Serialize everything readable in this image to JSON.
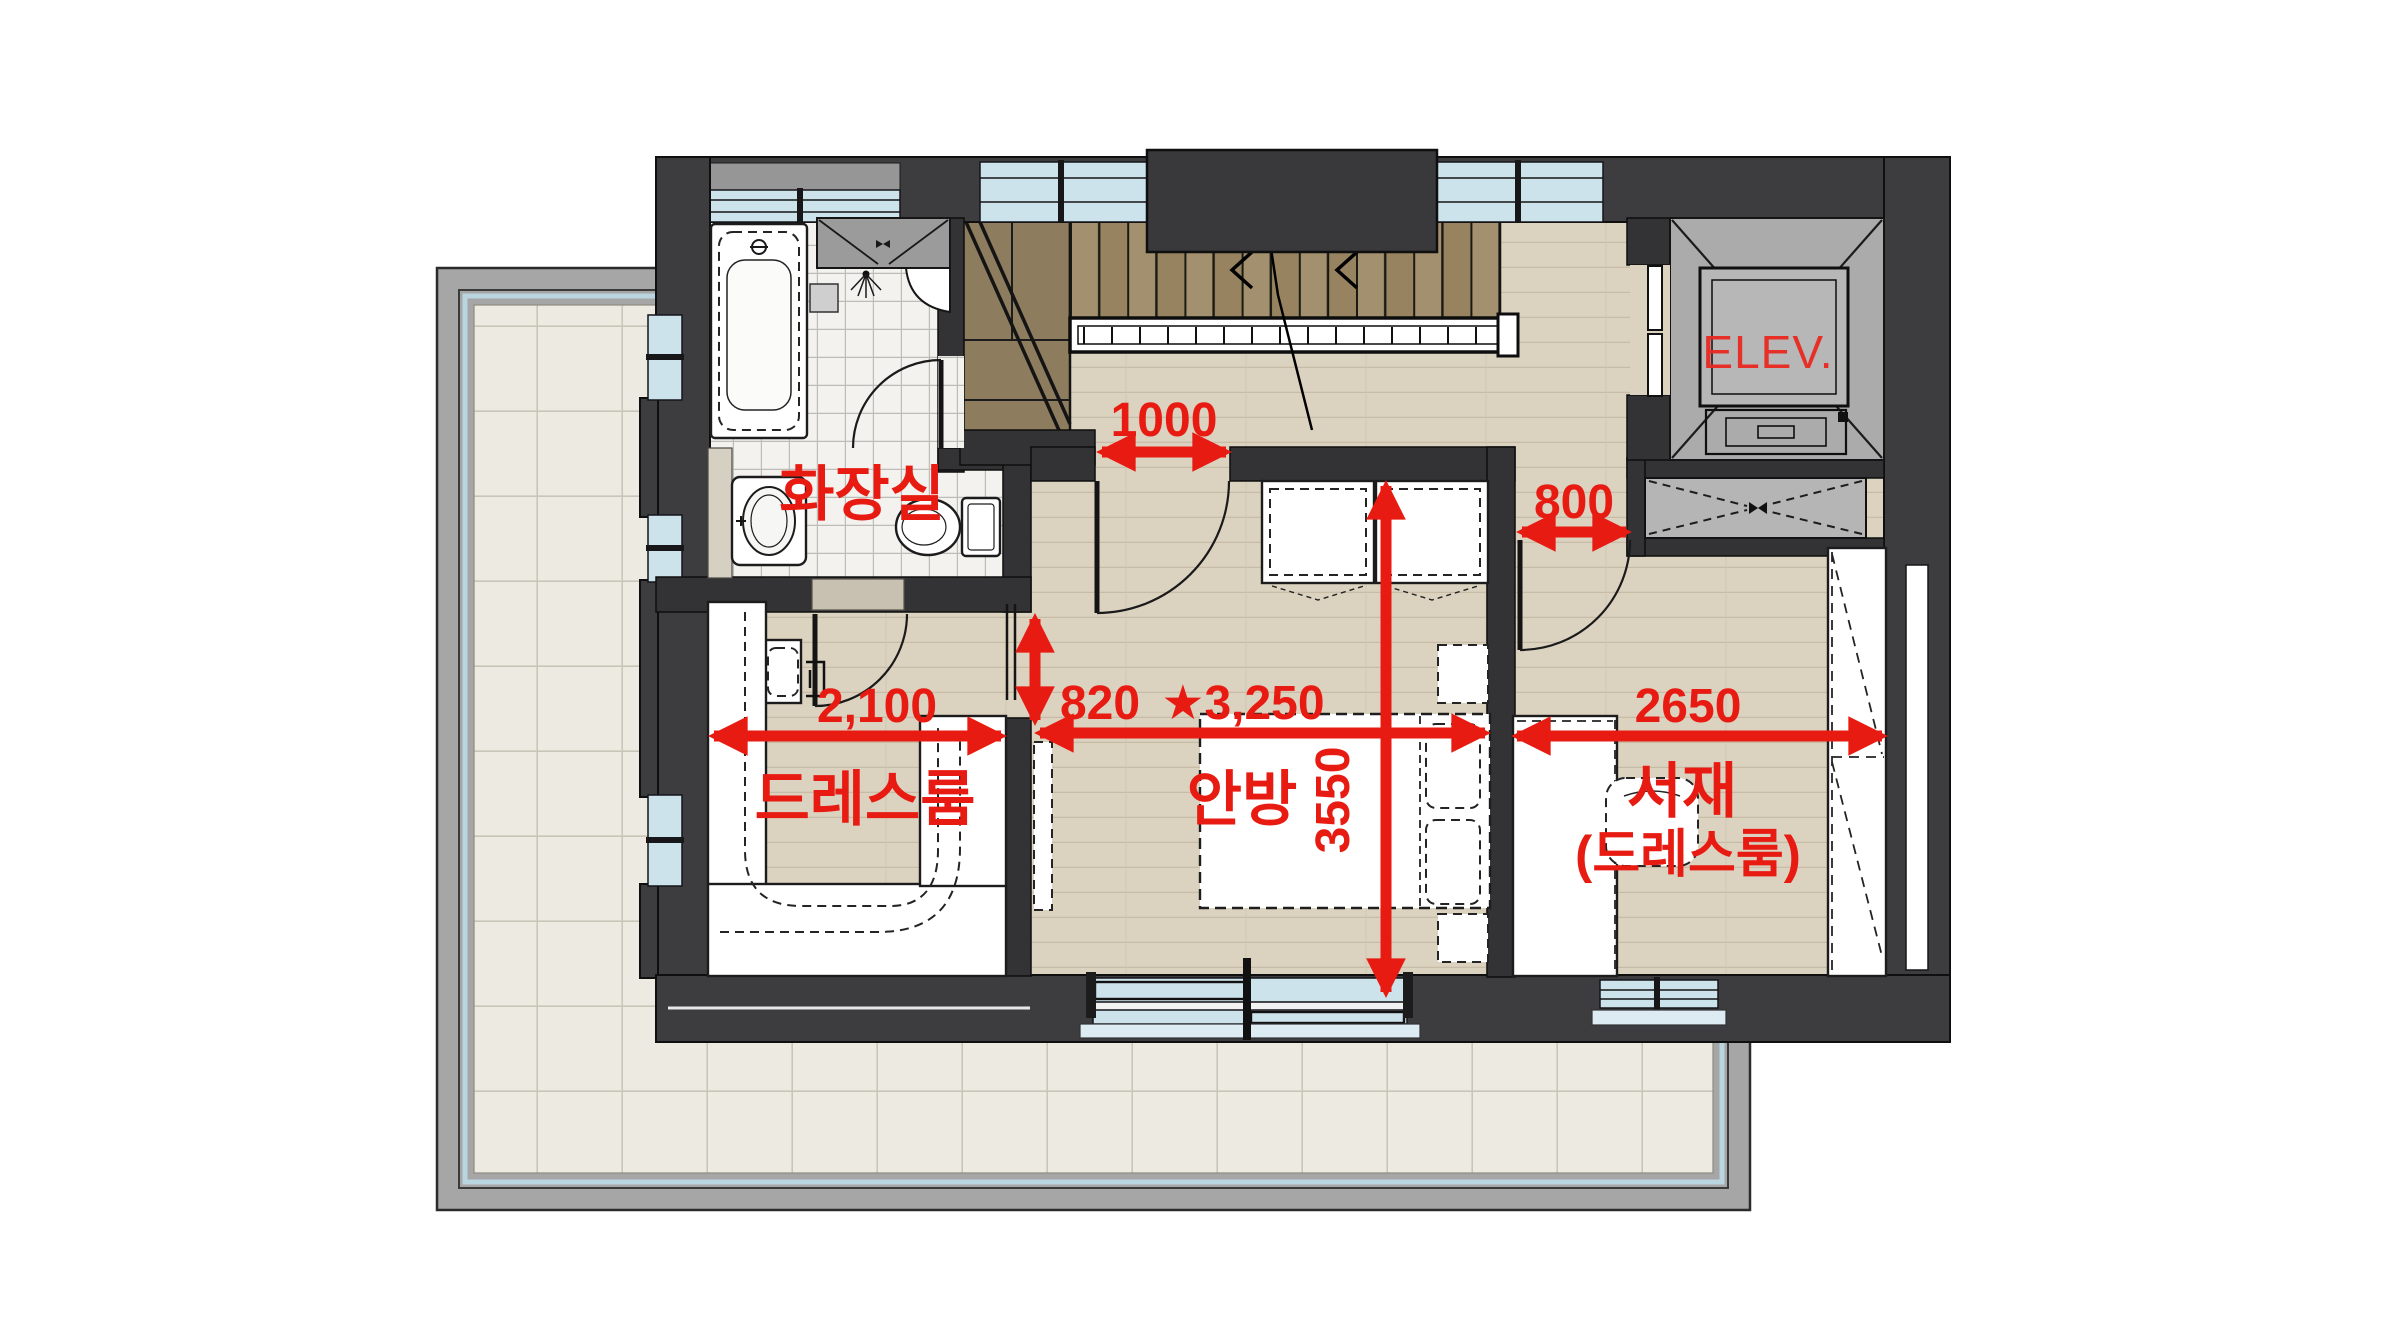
{
  "image_type": "second-floor architectural floor plan with red dimension annotations",
  "labels": {
    "bathroom": "화장실",
    "dressroom": "드레스룸",
    "master_bedroom": "안방",
    "study": "서재",
    "study_sub": "(드레스룸)",
    "elevator": "ELEV."
  },
  "dims": {
    "hall_opening": "1000",
    "study_door": "800",
    "dressroom_opening": "820",
    "dressroom_width": "2,100",
    "master_bedroom_width": "★3,250",
    "master_bedroom_depth": "3550",
    "study_width": "2650"
  },
  "colors": {
    "annotation_red": "#e81b12",
    "wall_dark": "#3d3d3f",
    "interior_wall": "#333335",
    "window_blue": "#cde3eb",
    "wood_floor": "#dbd2c0",
    "stair_wood": "#97835f",
    "bath_tile": "#f3f2ee",
    "terrace_tile": "#edebe1",
    "terrace_frame_gray": "#a6a6a6",
    "elevator_gray": "#ababab"
  }
}
